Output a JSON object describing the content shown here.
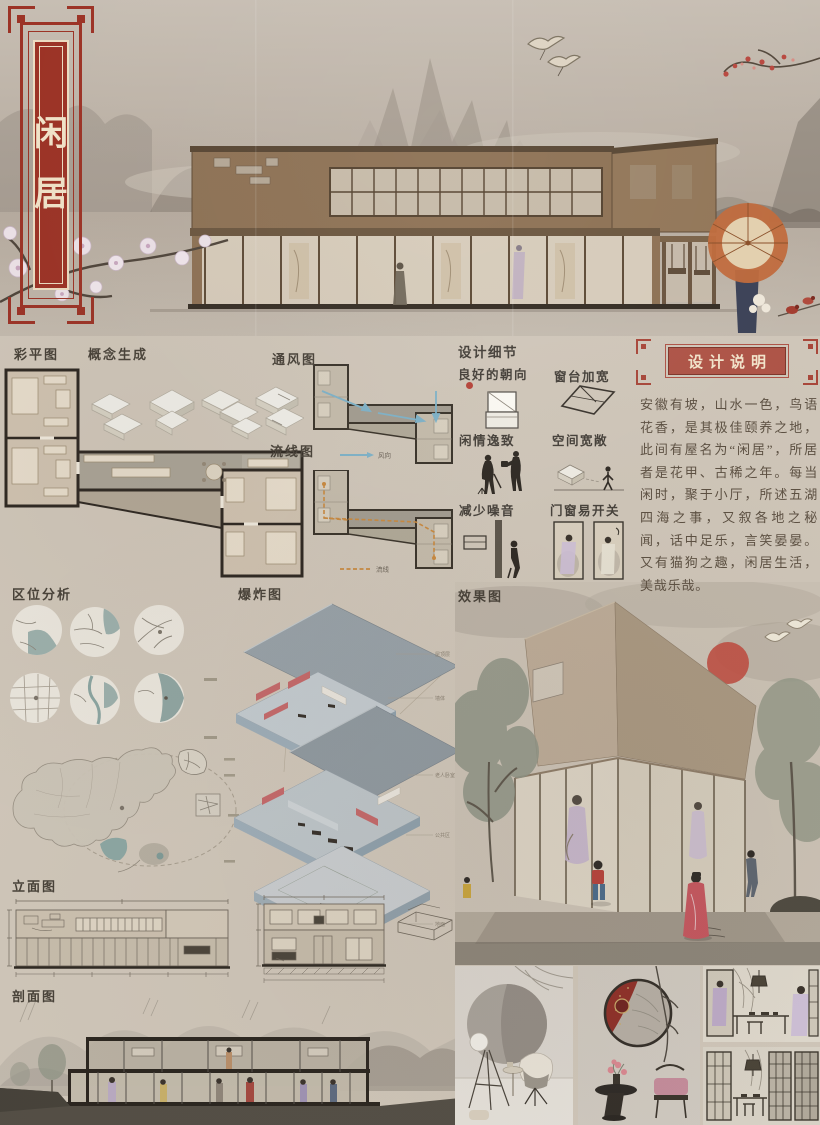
{
  "plaque": {
    "char_top": "闲",
    "char_bottom": "居"
  },
  "labels": {
    "color_plan": "彩平图",
    "concept": "概念生成",
    "ventilation": "通风图",
    "circulation": "流线图",
    "location": "区位分析",
    "exploded": "爆炸图",
    "render": "效果图",
    "elevation": "立面图",
    "section": "剖面图"
  },
  "details": {
    "title": "设计细节",
    "items": [
      "良好的朝向",
      "窗台加宽",
      "闲情逸致",
      "空间宽敞",
      "减少噪音",
      "门窗易开关"
    ]
  },
  "description": {
    "title": "设计说明",
    "body": "安徽有坡，山水一色，鸟语花香，是其极佳颐养之地，此间有屋名为“闲居”，所居者是花甲、古稀之年。每当闲时，聚于小厅，所述五湖四海之事，又叙各地之秘闻，话中足乐，言笑晏晏。又有猫狗之趣，闲居生活，美哉乐哉。"
  },
  "exploded": {
    "labels": [
      "屋顶层",
      "墙体",
      "老人卧室",
      "公共区",
      "地面"
    ]
  },
  "legends": {
    "wind": "风向",
    "flow": "流线"
  },
  "colors": {
    "accent_red": "#9c3326",
    "title_bar_red": "#ae5447",
    "sun_red": "#bf5044",
    "wind_blue": "#7eb2c8",
    "flow_orange": "#c8893f",
    "pink_partition": "#c4686a",
    "paper": "#cfc6b9"
  }
}
